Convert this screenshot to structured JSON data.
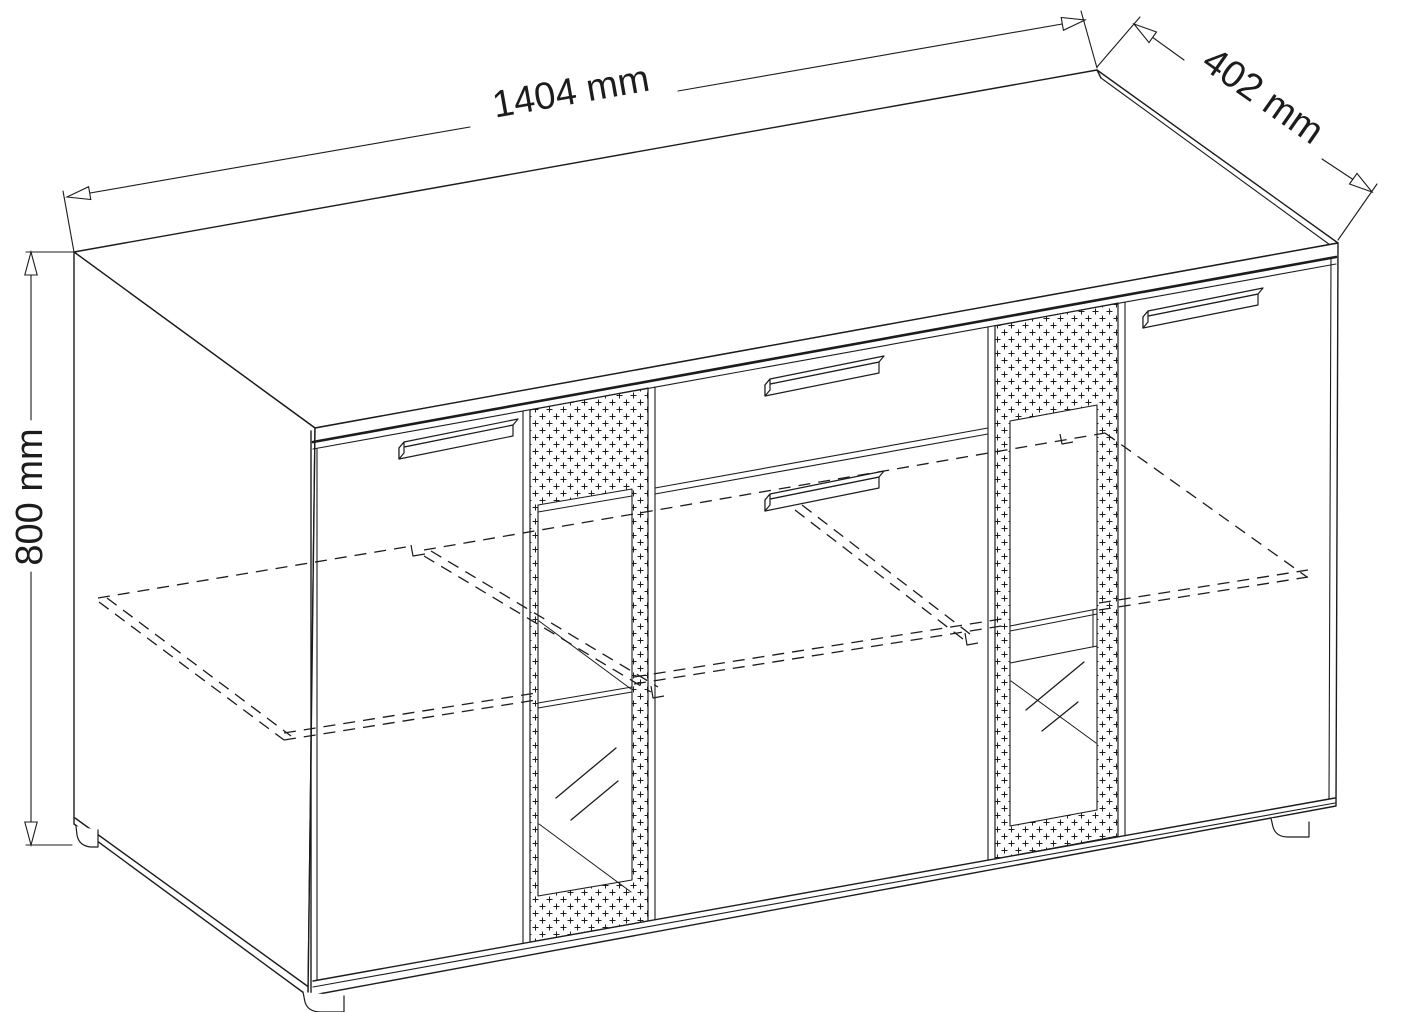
{
  "drawing": {
    "kind": "furniture-dimension-drawing",
    "object": "three-section sideboard with glass doors, drawer and interior shelf",
    "dimensions": {
      "width": {
        "label": "1404 mm",
        "value": 1404,
        "unit": "mm"
      },
      "depth": {
        "label": "402 mm",
        "value": 402,
        "unit": "mm"
      },
      "height": {
        "label": "800 mm",
        "value": 800,
        "unit": "mm"
      }
    },
    "colors": {
      "line": "#1c1c1c",
      "background": "#ffffff"
    }
  }
}
